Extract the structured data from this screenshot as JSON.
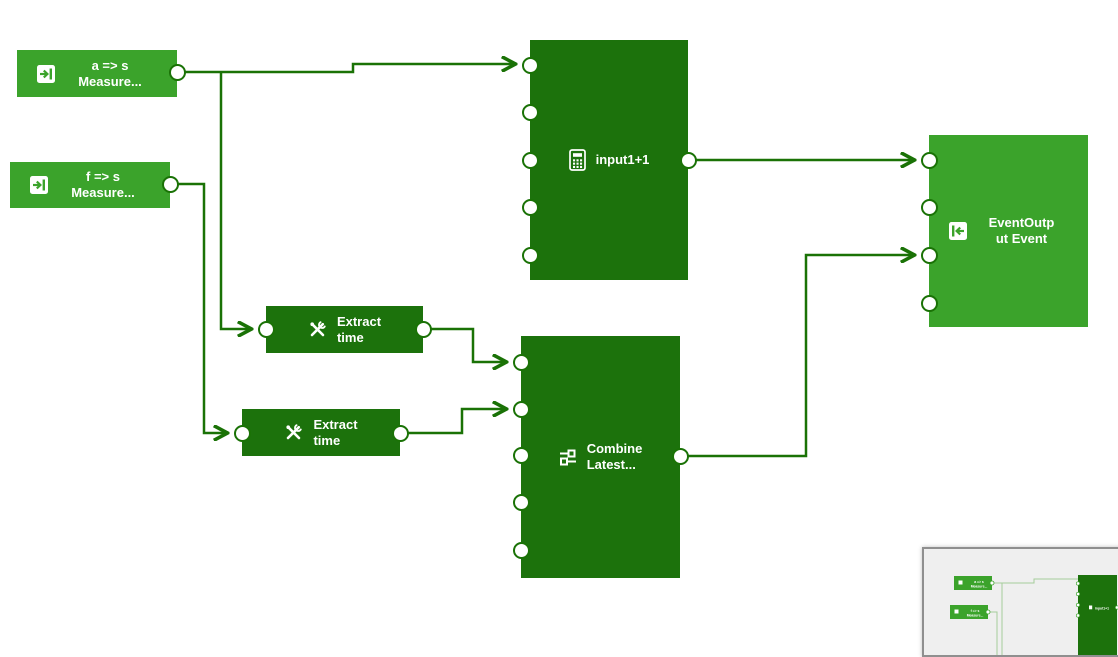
{
  "app": {
    "view": "pipeline-editor-canvas"
  },
  "colors": {
    "node_light_green": "#3ba32b",
    "node_dark_green": "#1c720c",
    "wire": "#1a7206",
    "port_fill": "#ffffff",
    "node_text": "#ffffff",
    "minimap_bg": "#efefef",
    "minimap_border": "#8f8f8f",
    "minimap_wire": "#a5cc9b"
  },
  "nodes": {
    "measure_a": {
      "line1": "a => s",
      "line2": "Measure...",
      "icon": "input-arrow-icon",
      "inputs": 0,
      "outputs": 1
    },
    "measure_f": {
      "line1": "f => s",
      "line2": "Measure...",
      "icon": "input-arrow-icon",
      "inputs": 0,
      "outputs": 1
    },
    "calculation": {
      "label": "input1+1",
      "icon": "calculator-icon",
      "inputs": 5,
      "outputs": 1
    },
    "extract_time_1": {
      "line1": "Extract",
      "line2": "time",
      "icon": "tools-icon",
      "inputs": 1,
      "outputs": 1
    },
    "extract_time_2": {
      "line1": "Extract",
      "line2": "time",
      "icon": "tools-icon",
      "inputs": 1,
      "outputs": 1
    },
    "combine_latest": {
      "line1": "Combine",
      "line2": "Latest...",
      "icon": "combine-icon",
      "inputs": 5,
      "outputs": 1
    },
    "event_output": {
      "line1": "EventOutp",
      "line2": "ut Event",
      "icon": "output-arrow-icon",
      "inputs": 4,
      "outputs": 0
    }
  },
  "edges": [
    {
      "from": "measure_a.out",
      "to": "calculation.in1"
    },
    {
      "from": "measure_a.out",
      "to": "extract_time_1.in"
    },
    {
      "from": "measure_f.out",
      "to": "extract_time_2.in"
    },
    {
      "from": "extract_time_1.out",
      "to": "combine_latest.in1"
    },
    {
      "from": "extract_time_2.out",
      "to": "combine_latest.in2"
    },
    {
      "from": "calculation.out",
      "to": "event_output.in1"
    },
    {
      "from": "combine_latest.out",
      "to": "event_output.in3"
    }
  ],
  "minimap": {
    "nodes": [
      {
        "line1": "a => s",
        "line2": "Measure..."
      },
      {
        "line1": "f => s",
        "line2": "Measure..."
      },
      {
        "label": "input1+1"
      }
    ]
  }
}
